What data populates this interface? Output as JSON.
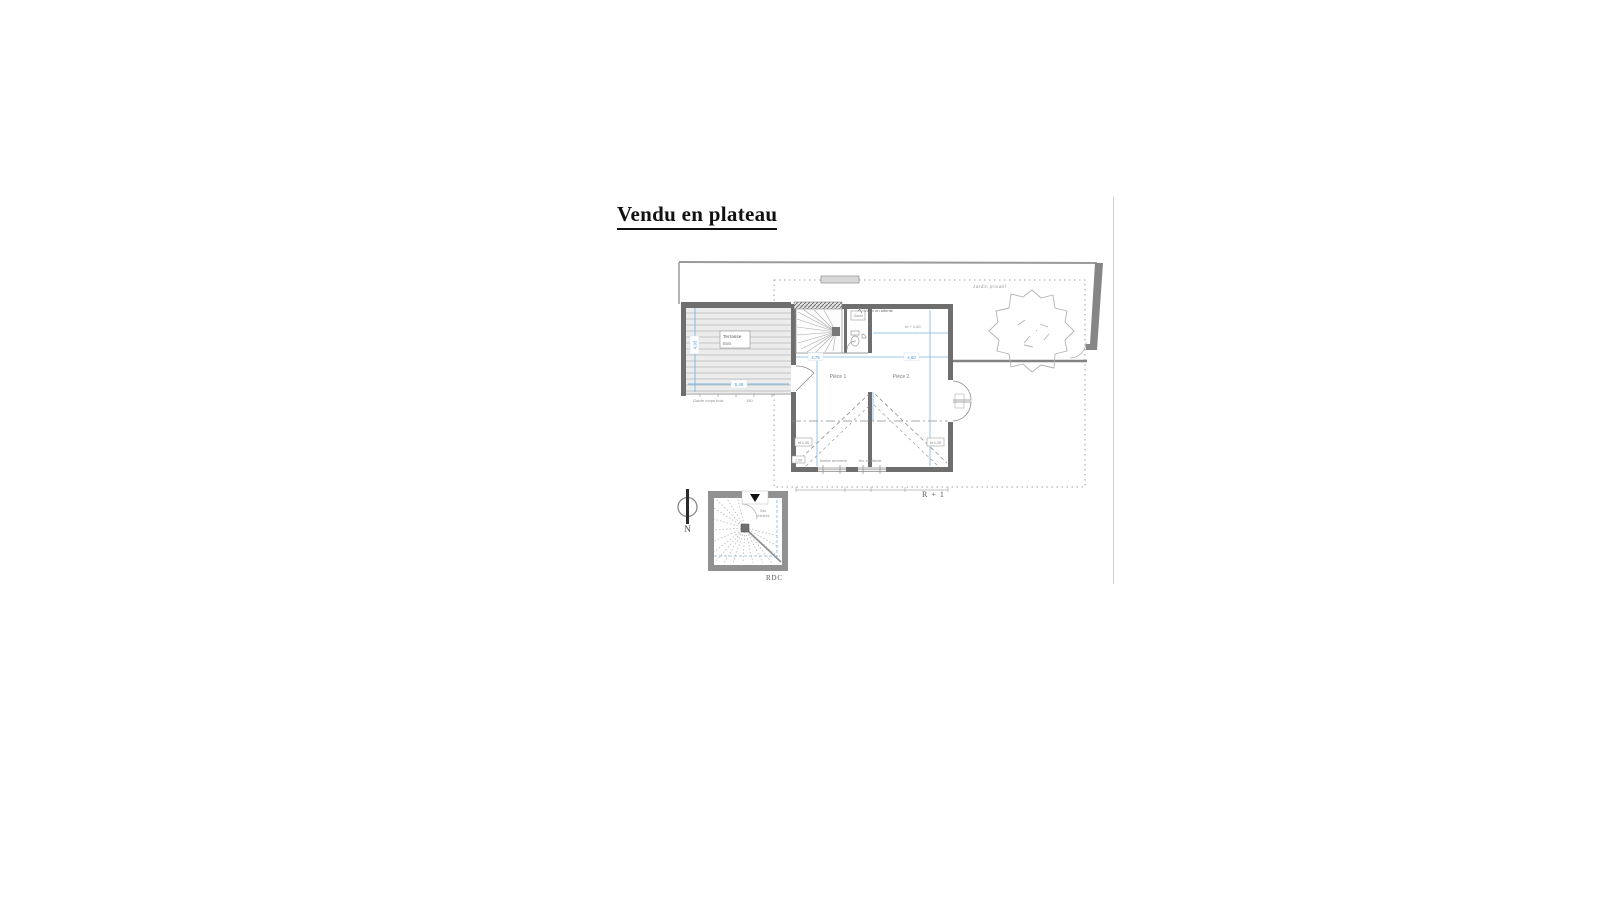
{
  "title": "Vendu en plateau",
  "labels": {
    "floor_upper": "R + 1",
    "floor_ground": "RDC",
    "compass": "N",
    "garden": "Jardin privatif",
    "velux": "Vélux en attente",
    "height_line": "ht + 1,80",
    "room1": "Pièce 1",
    "room2": "Pièce 2",
    "terrace_line1": "Terrasse",
    "terrace_line2": "Bois",
    "guardrail": "Garde corps bois",
    "guardrail_dim": "150",
    "closet": "Gaine",
    "entry_line1": "Sas",
    "entry_line2": "d'entrée",
    "window_left": "fenêtre serrurerie",
    "window_right": "fen. en attente"
  },
  "dimensions": {
    "terrace_width": "5,48",
    "terrace_height": "4,93",
    "room1_width": "4,75",
    "room2_width": "4,60",
    "height_left": "ht 1,20",
    "height_right": "ht 1,20",
    "door_width": "1,00"
  },
  "colors": {
    "wall_dark": "#6e6e6e",
    "wall_mid": "#919191",
    "line_gray": "#9a9a9a",
    "dim_blue": "#5fa8d5",
    "text_gray": "#8a8a8a"
  }
}
